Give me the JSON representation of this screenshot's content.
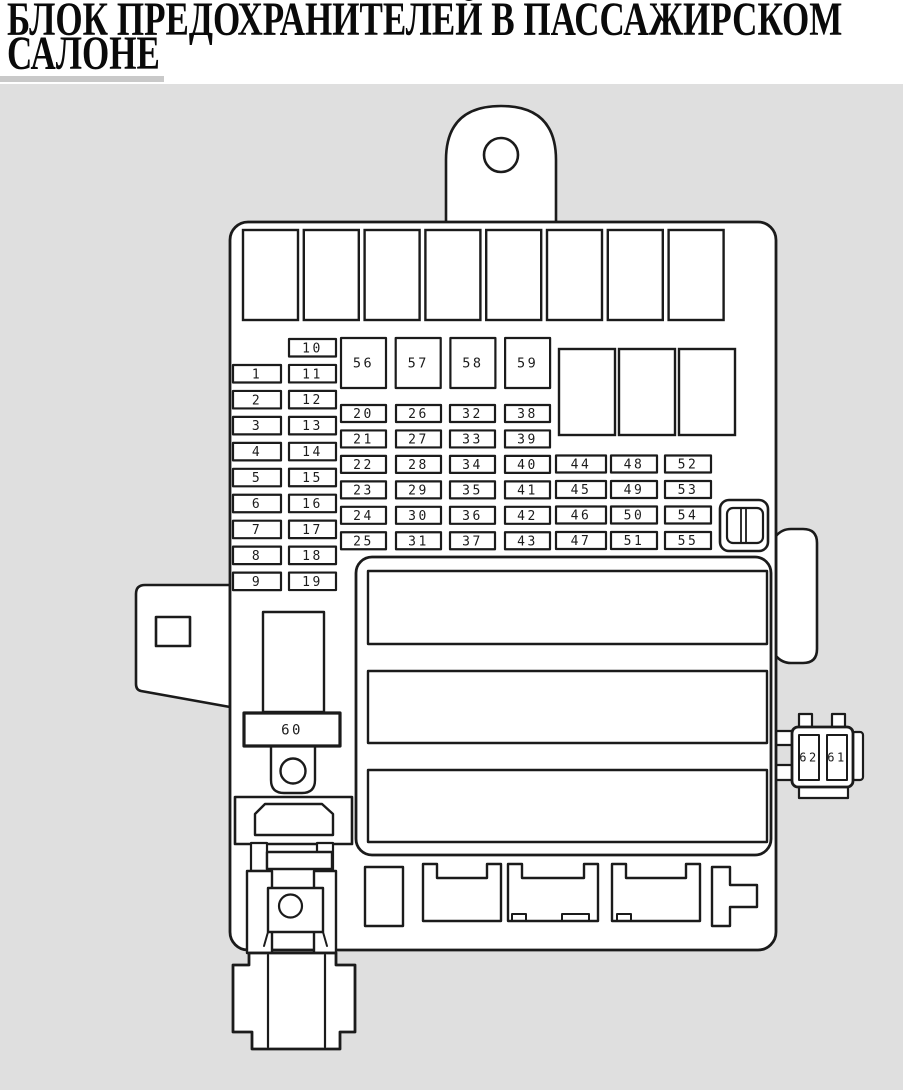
{
  "title": {
    "line1": "БЛОК ПРЕДОХРАНИТЕЛЕЙ В ПАССАЖИРСКОМ",
    "line2": "САЛОНЕ"
  },
  "colors": {
    "header_bg": "#ffffff",
    "title_text": "#0a0a0a",
    "title_underline": "#c9c9c9",
    "diagram_bg": "#dfdfdf",
    "line": "#1b1b1b",
    "fill": "#ffffff"
  },
  "fuse_labels": {
    "column_a": [
      "1",
      "2",
      "3",
      "4",
      "5",
      "6",
      "7",
      "8",
      "9"
    ],
    "column_b": [
      "10",
      "11",
      "12",
      "13",
      "14",
      "15",
      "16",
      "17",
      "18",
      "19"
    ],
    "squares": [
      "56",
      "57",
      "58",
      "59"
    ],
    "mid_grid": [
      "20",
      "21",
      "22",
      "23",
      "24",
      "25",
      "26",
      "27",
      "28",
      "29",
      "30",
      "31",
      "32",
      "33",
      "34",
      "35",
      "36",
      "37",
      "38",
      "39",
      "40",
      "41",
      "42",
      "43"
    ],
    "right_grid": [
      "44",
      "45",
      "46",
      "47",
      "48",
      "49",
      "50",
      "51",
      "52",
      "53",
      "54",
      "55"
    ],
    "relay": "60",
    "side_connector": [
      "62",
      "61"
    ]
  }
}
